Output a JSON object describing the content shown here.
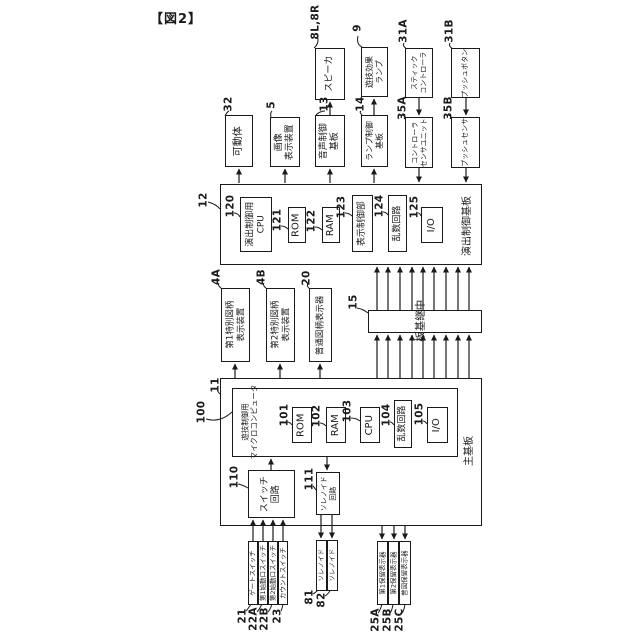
{
  "figure": {
    "caption": "【図2】"
  },
  "colors": {
    "line": "#1a1a1a",
    "background": "#ffffff"
  },
  "blocks": {
    "movable_body": {
      "ref": "32",
      "label": "可動体"
    },
    "image_display_device": {
      "ref": "5",
      "label": "画像\n表示装置"
    },
    "audio_control_board": {
      "ref": "13",
      "label": "音声制御\n基板"
    },
    "speaker": {
      "ref": "8L,8R",
      "label": "スピーカ"
    },
    "lamp_control_board": {
      "ref": "14",
      "label": "ランプ制御\n基板"
    },
    "game_effect_lamp": {
      "ref": "9",
      "label": "遊技効果\nランプ"
    },
    "stick_controller": {
      "ref": "31A",
      "label": "スティック\nコントローラ"
    },
    "controller_sensor_unit": {
      "ref": "35A",
      "label": "コントローラ\nセンサユニット"
    },
    "push_button": {
      "ref": "31B",
      "label": "プッシュボタン"
    },
    "push_sensor": {
      "ref": "35B",
      "label": "プッシュセンサ"
    },
    "effect_control_board": {
      "ref": "12",
      "label": "演出制御基板"
    },
    "effect_cpu": {
      "ref": "120",
      "label": "演出制御用\nCPU"
    },
    "effect_rom": {
      "ref": "121",
      "label": "ROM"
    },
    "effect_ram": {
      "ref": "122",
      "label": "RAM"
    },
    "display_control_unit": {
      "ref": "123",
      "label": "表示制御部"
    },
    "effect_random_circuit": {
      "ref": "124",
      "label": "乱数回路"
    },
    "effect_io": {
      "ref": "125",
      "label": "I/O"
    },
    "first_special_symbol_display": {
      "ref": "4A",
      "label": "第1特別図柄\n表示装置"
    },
    "second_special_symbol_display": {
      "ref": "4B",
      "label": "第2特別図柄\n表示装置"
    },
    "normal_symbol_display": {
      "ref": "20",
      "label": "普通図柄表示器"
    },
    "relay_board": {
      "ref": "15",
      "label": "中継基板"
    },
    "main_board": {
      "ref": "11",
      "label": "主基板"
    },
    "game_control_microcomputer": {
      "ref": "100",
      "label": "遊技制御用\nマイクロコンピュータ"
    },
    "main_rom": {
      "ref": "101",
      "label": "ROM"
    },
    "main_ram": {
      "ref": "102",
      "label": "RAM"
    },
    "main_cpu": {
      "ref": "103",
      "label": "CPU"
    },
    "main_random_circuit": {
      "ref": "104",
      "label": "乱数回路"
    },
    "main_io": {
      "ref": "105",
      "label": "I/O"
    },
    "switch_circuit": {
      "ref": "110",
      "label": "スイッチ\n回路"
    },
    "solenoid_circuit": {
      "ref": "111",
      "label": "ソレノイド\n回路"
    },
    "gate_switch": {
      "ref": "21",
      "label": "ゲートスイッチ"
    },
    "first_start_switch": {
      "ref": "22A",
      "label": "第1始動口スイッチ"
    },
    "second_start_switch": {
      "ref": "22B",
      "label": "第2始動口スイッチ"
    },
    "count_switch": {
      "ref": "23",
      "label": "カウントスイッチ"
    },
    "solenoid_81": {
      "ref": "81",
      "label": "ソレノイド"
    },
    "solenoid_82": {
      "ref": "82",
      "label": "ソレノイド"
    },
    "first_hold_display": {
      "ref": "25A",
      "label": "第1保留表示器"
    },
    "second_hold_display": {
      "ref": "25B",
      "label": "第2保留表示器"
    },
    "normal_hold_display": {
      "ref": "25C",
      "label": "普図保留表示器"
    }
  }
}
